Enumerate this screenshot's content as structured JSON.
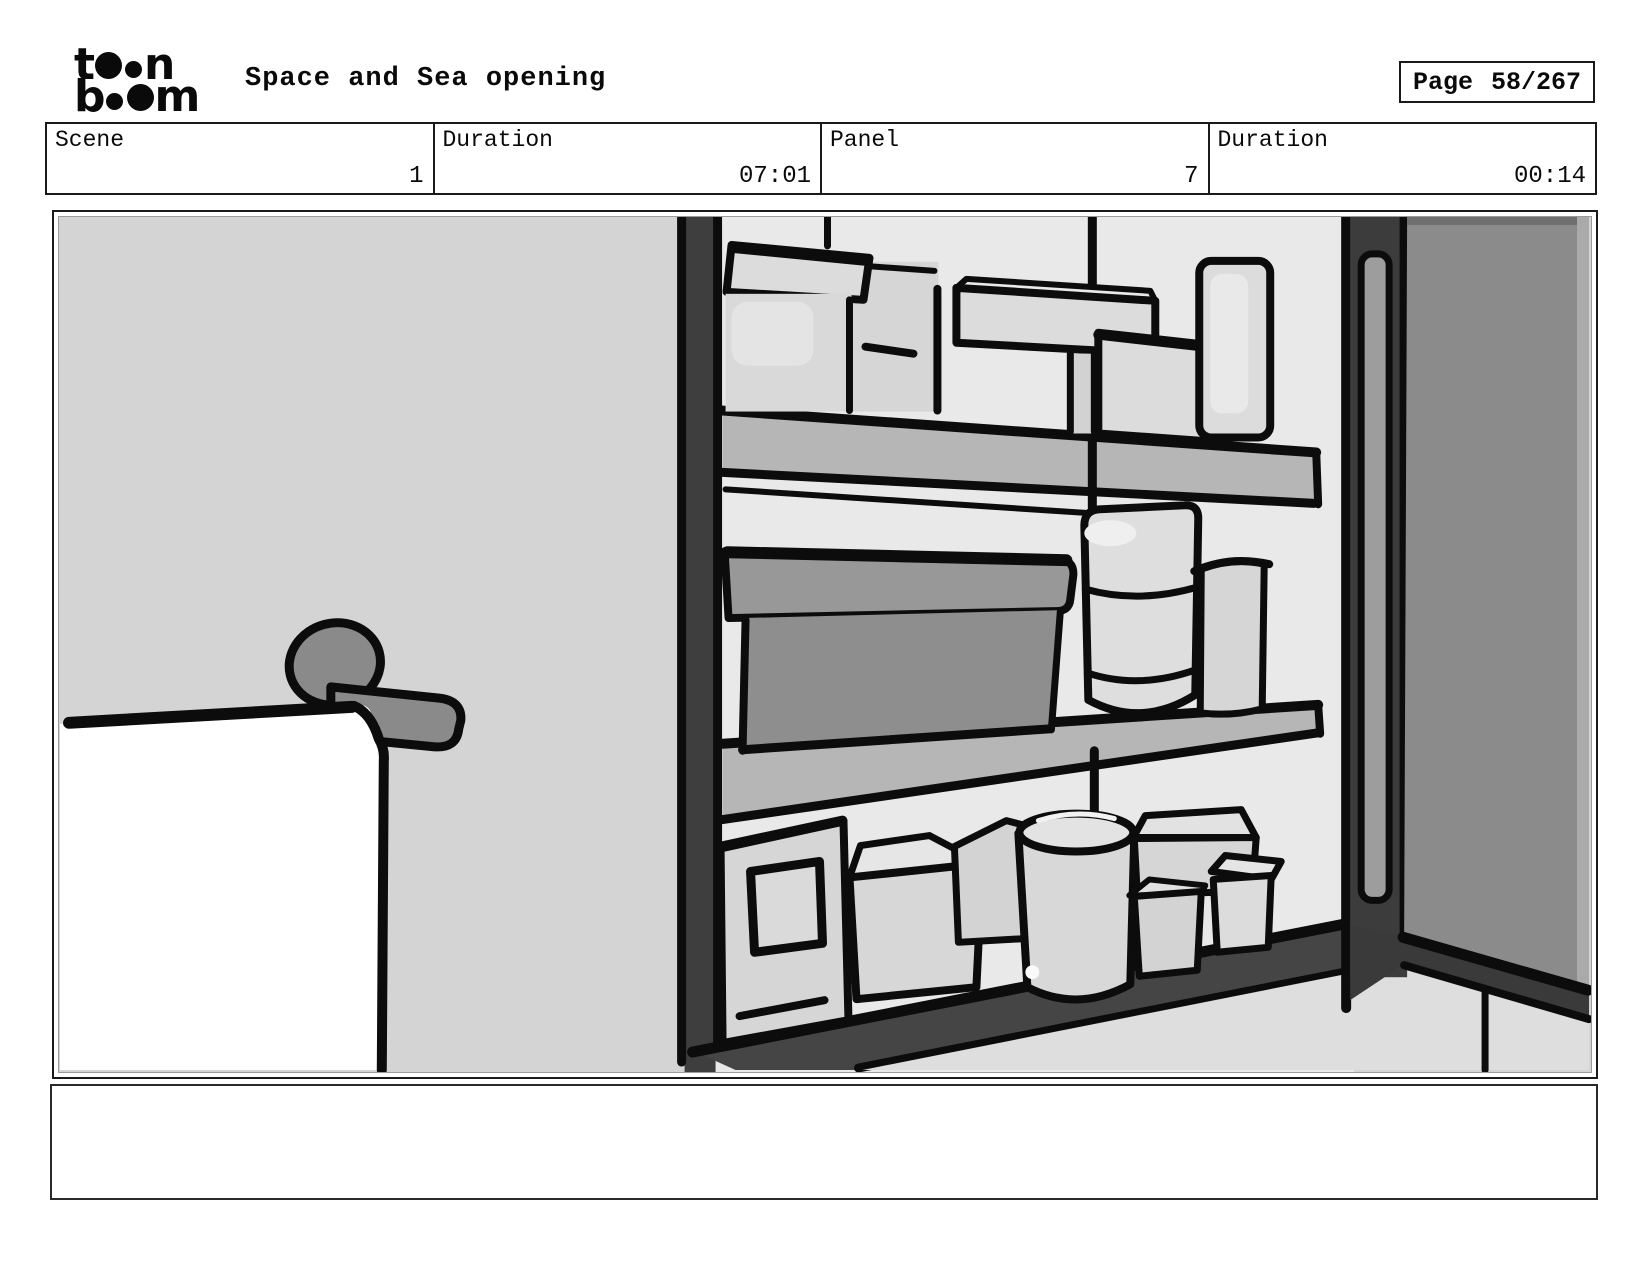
{
  "brand": {
    "l1a": "t",
    "l1b": "n",
    "l2a": "b",
    "l2b": "m"
  },
  "header": {
    "title": "Space and Sea opening",
    "page_label": "Page",
    "page_value": "58/267"
  },
  "info_row": {
    "cells": [
      {
        "label": "Scene",
        "value": "1"
      },
      {
        "label": "Duration",
        "value": "07:01"
      },
      {
        "label": "Panel",
        "value": "7"
      },
      {
        "label": "Duration",
        "value": "00:14"
      }
    ]
  },
  "panel": {
    "description": "Hand-drawn storyboard sketch: open wall cabinet with three shelves holding boxes and canisters, open gray door on the right, white towel hanging on a wall bar at lower left"
  },
  "caption": {
    "text": ""
  },
  "colors": {
    "wall": "#d4d4d4",
    "cabinet_interior": "#e9e9e9",
    "cabinet_frame": "#3e3e3e",
    "shelf": "#b6b6b6",
    "door": "#8b8b8b",
    "dark_box": "#8e8e8e",
    "light_items": "#d8d8d8",
    "towel": "#ffffff",
    "outline": "#0c0c0c"
  }
}
